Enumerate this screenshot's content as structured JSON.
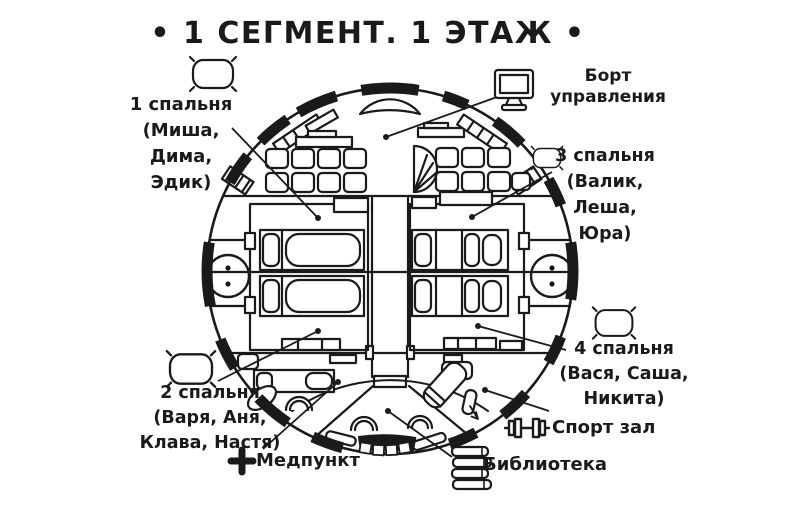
{
  "title": "• 1 СЕГМЕНТ. 1 ЭТАЖ •",
  "labels": {
    "bedroom1": {
      "lines": [
        "1 спальня",
        "(Миша,",
        "Дима,",
        "Эдик)"
      ]
    },
    "control_deck": {
      "lines": [
        "Борт",
        "управления"
      ]
    },
    "bedroom3": {
      "lines": [
        "3 спальня",
        "(Валик,",
        "Леша,",
        "Юра)"
      ]
    },
    "bedroom4": {
      "lines": [
        "4 спальня",
        "(Вася, Саша,",
        "Никита)"
      ]
    },
    "bedroom2": {
      "lines": [
        "2 спальня",
        "(Варя, Аня,",
        "Клава, Настя)"
      ]
    },
    "gym": "Спорт зал",
    "library": "Библиотека",
    "med_point": "Медпункт"
  },
  "icons": [
    "pillow-icon",
    "monitor-icon",
    "dumbbell-icon",
    "books-icon",
    "medical-cross-icon"
  ],
  "colors": {
    "ink": "#1a1a1a",
    "paper": "#ffffff"
  }
}
